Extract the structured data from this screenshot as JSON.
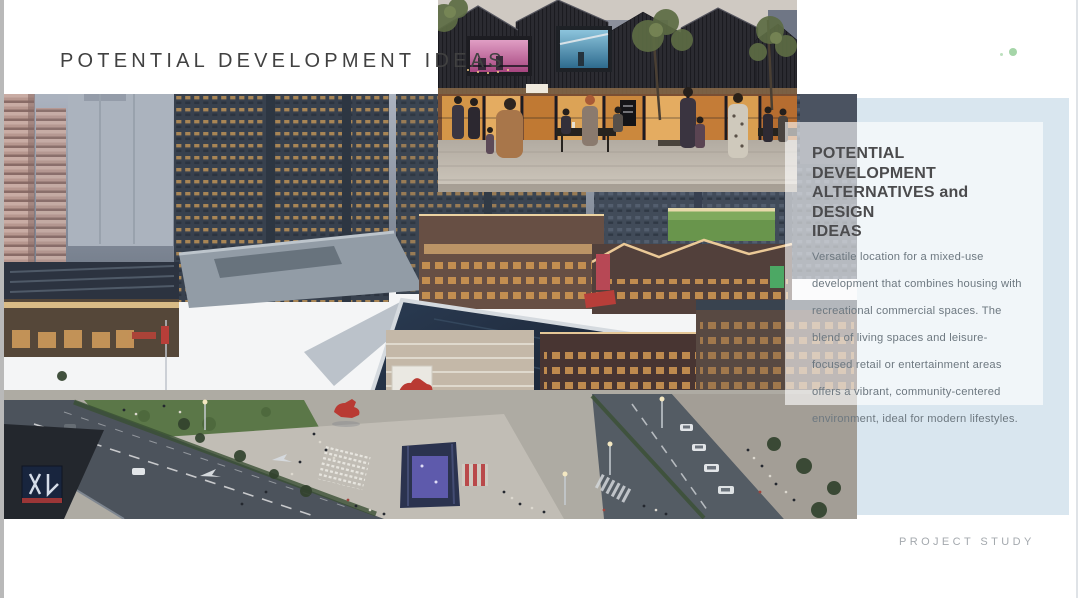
{
  "slide": {
    "title": "POTENTIAL DEVELOPMENT IDEAS",
    "card": {
      "heading": "POTENTIAL DEVELOPMENT\nALTERNATIVES and DESIGN\nIDEAS",
      "body": "Versatile location for a mixed-use development that combines housing with recreational commercial spaces. The blend of living spaces and leisure-focused retail or entertainment areas offers a vibrant, community-centered environment, ideal for modern lifestyles."
    },
    "footer": "PROJECT STUDY",
    "colors": {
      "panel_blue": "#d9e6ef",
      "card_overlay": "rgba(255,255,255,0.62)",
      "title_text": "#414141",
      "heading_text": "#4b4b4d",
      "body_text": "#6d7880",
      "footer_text": "#a4a9ae",
      "indicator_green": "#8fcb92"
    }
  }
}
